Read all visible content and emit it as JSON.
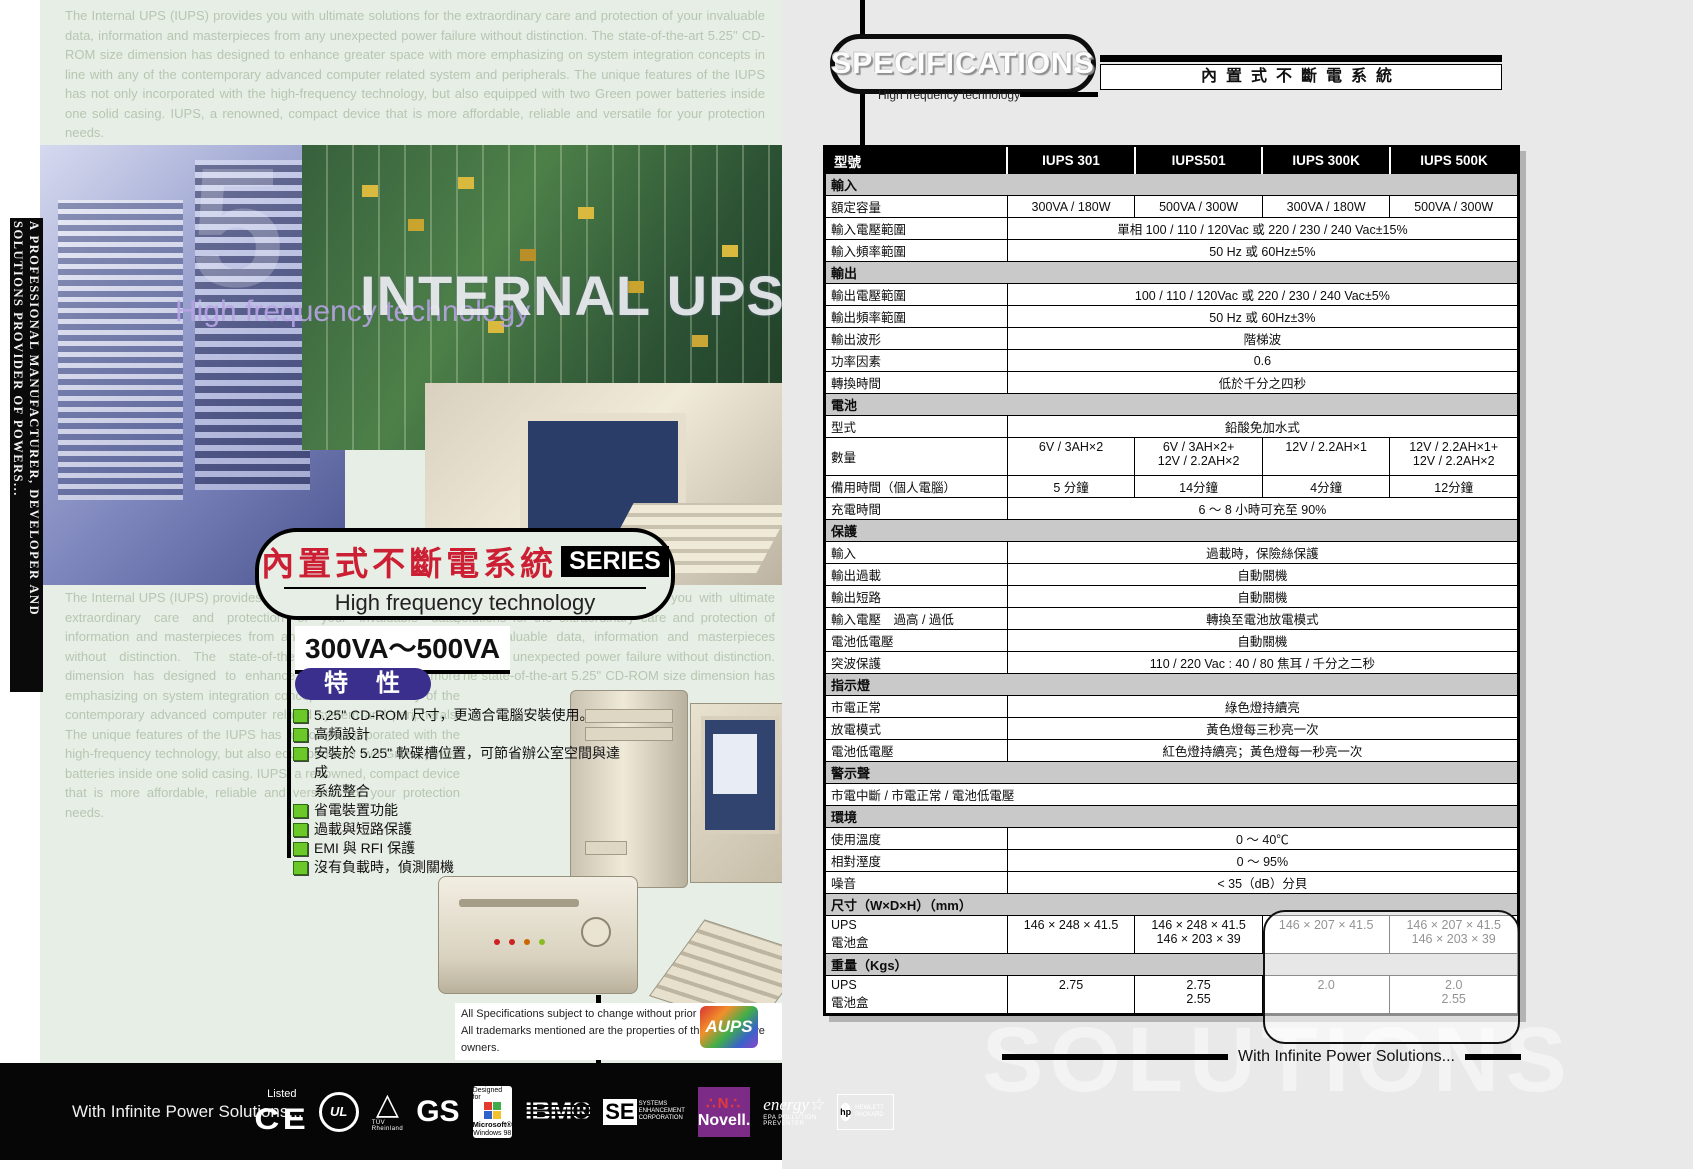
{
  "left_page": {
    "sidebar_text": "A PROFESSIONAL MANUFACTURER, DEVELOPER AND SOLUTIONS PROVIDER OF POWERS...",
    "background_text": "The Internal UPS (IUPS) provides you with ultimate solutions for the extraordinary care and protection of your invaluable data, information and masterpieces from any unexpected power failure without distinction. The state-of-the-art 5.25\" CD-ROM size dimension has designed to enhance greater space with more emphasizing on system integration concepts in line with any of the contemporary advanced computer related system and peripherals. The unique features of the IUPS has not only incorporated with the high-frequency technology, but also equipped with two Green power batteries inside one solid casing. IUPS, a renowned, compact device that is more affordable, reliable and versatile for your protection needs.",
    "collage": {
      "watermark_number": "5",
      "overlay_purple": "High frequency technology",
      "overlay_white": "INTERNAL UPS"
    },
    "title": {
      "chinese": "內置式不斷電系統",
      "series": "SERIES",
      "subtitle": "High frequency technology"
    },
    "range": "300VA～500VA",
    "features_heading": "特　性",
    "features": [
      {
        "text": "5.25\" CD-ROM 尺寸，更適合電腦安裝使用。"
      },
      {
        "text": "高頻設計"
      },
      {
        "text": "安裝於 5.25\" 軟碟槽位置，可節省辦公室空間與達成"
      },
      {
        "text": "系統整合",
        "cont": true
      },
      {
        "text": "省電裝置功能"
      },
      {
        "text": "過載與短路保護"
      },
      {
        "text": "EMI 與 RFI 保護"
      },
      {
        "text": "沒有負載時，偵測關機"
      }
    ],
    "disclaimer": [
      "All Specifications subject to change without prior notice,",
      "All trademarks mentioned are the properties of their respective owners."
    ],
    "footer": {
      "slogan": "With Infinite Power Solutions...",
      "logos": {
        "listed": "Listed",
        "ce": "CE",
        "ul": "UL",
        "tuv_mark": "△",
        "tuv": "TÜV Rheinland",
        "gs": "GS",
        "win_designed": "Designed for",
        "win_ms": "Microsoft®",
        "win_98": "Windows 98",
        "ibm": "IBM®",
        "se": "SE",
        "se_sub": "SYSTEMS ENHANCEMENT CORPORATION",
        "novell_n": "∴N∴",
        "novell": "Novell.",
        "energy": "energy☆",
        "energy_sub": "EPA POLLUTION PREVENTER",
        "hp": "hp",
        "hp_sub": "HEWLETT PACKARD",
        "aups": "AUPS"
      }
    },
    "led_colors": [
      "#cc2222",
      "#cc2222",
      "#cc6600",
      "#88bb22"
    ]
  },
  "right_page": {
    "header": {
      "title": "SPECIFICATIONS",
      "subtitle": "High frequency technology",
      "banner": "內置式不斷電系統"
    },
    "table": {
      "rows": [
        {
          "t": "h",
          "c": [
            "型號",
            "IUPS 301",
            "IUPS501",
            "IUPS 300K",
            "IUPS 500K"
          ]
        },
        {
          "t": "sec",
          "l": "輸入"
        },
        {
          "t": "d",
          "l": "額定容量",
          "v": [
            "300VA / 180W",
            "500VA / 300W",
            "300VA / 180W",
            "500VA / 300W"
          ]
        },
        {
          "t": "sp",
          "l": "輸入電壓範圍",
          "v": "單相 100 / 110 / 120Vac 或 220 / 230 / 240 Vac±15%"
        },
        {
          "t": "sp",
          "l": "輸入頻率範圍",
          "v": "50 Hz 或 60Hz±5%"
        },
        {
          "t": "sec",
          "l": "輸出"
        },
        {
          "t": "sp",
          "l": "輸出電壓範圍",
          "v": "100 / 110 / 120Vac 或 220 / 230 / 240 Vac±5%"
        },
        {
          "t": "sp",
          "l": "輸出頻率範圍",
          "v": "50 Hz 或 60Hz±3%"
        },
        {
          "t": "sp",
          "l": "輸出波形",
          "v": "階梯波"
        },
        {
          "t": "sp",
          "l": "功率因素",
          "v": "0.6"
        },
        {
          "t": "sp",
          "l": "轉換時間",
          "v": "低於千分之四秒"
        },
        {
          "t": "sec",
          "l": "電池"
        },
        {
          "t": "sp",
          "l": "型式",
          "v": "鉛酸免加水式"
        },
        {
          "t": "d",
          "l": "數量",
          "v": [
            "6V / 3AH×2",
            "6V / 3AH×2+\n12V / 2.2AH×2",
            "12V / 2.2AH×1",
            "12V / 2.2AH×1+\n12V / 2.2AH×2"
          ],
          "tall": true
        },
        {
          "t": "d",
          "l": "備用時間（個人電腦）",
          "v": [
            "5 分鐘",
            "14分鐘",
            "4分鐘",
            "12分鐘"
          ]
        },
        {
          "t": "sp",
          "l": "充電時間",
          "v": "6 ～ 8 小時可充至 90%"
        },
        {
          "t": "sec",
          "l": "保護"
        },
        {
          "t": "sp",
          "l": "輸入",
          "v": "過載時，保險絲保護"
        },
        {
          "t": "sp",
          "l": "輸出過載",
          "v": "自動關機"
        },
        {
          "t": "sp",
          "l": "輸出短路",
          "v": "自動關機"
        },
        {
          "t": "sp",
          "l": "輸入電壓　過高 / 過低",
          "v": "轉換至電池放電模式"
        },
        {
          "t": "sp",
          "l": "電池低電壓",
          "v": "自動關機"
        },
        {
          "t": "sp",
          "l": "突波保護",
          "v": "110 / 220 Vac : 40 / 80 焦耳 / 千分之二秒"
        },
        {
          "t": "sec",
          "l": "指示燈"
        },
        {
          "t": "sp",
          "l": "市電正常",
          "v": "綠色燈持續亮"
        },
        {
          "t": "sp",
          "l": "放電模式",
          "v": "黃色燈每三秒亮一次"
        },
        {
          "t": "sp",
          "l": "電池低電壓",
          "v": "紅色燈持續亮；黃色燈每一秒亮一次"
        },
        {
          "t": "sec",
          "l": "警示聲"
        },
        {
          "t": "full",
          "l": "市電中斷 / 市電正常 / 電池低電壓"
        },
        {
          "t": "sec",
          "l": "環境"
        },
        {
          "t": "sp",
          "l": "使用溫度",
          "v": "0 ～ 40℃"
        },
        {
          "t": "sp",
          "l": "相對溼度",
          "v": "0 ～ 95%"
        },
        {
          "t": "sp",
          "l": "噪音",
          "v": "< 35（dB）分貝"
        },
        {
          "t": "sec",
          "l": "尺寸（W×D×H）（mm）"
        },
        {
          "t": "d",
          "l": "UPS\n電池盒",
          "v": [
            "146 × 248 × 41.5",
            "146 × 248 × 41.5\n146 × 203 × 39",
            "146 × 207 × 41.5",
            "146 × 207 × 41.5\n146 × 203 × 39"
          ],
          "tall": true
        },
        {
          "t": "sec",
          "l": "重量（Kgs）"
        },
        {
          "t": "d",
          "l": "UPS\n電池盒",
          "v": [
            "2.75",
            "2.75\n2.55",
            "2.0",
            "2.0\n2.55"
          ],
          "tall": true
        }
      ]
    },
    "watermark": {
      "line1": "VERS",
      "line2": "SOLUTIONS"
    },
    "footer_slogan": "With Infinite Power Solutions..."
  }
}
